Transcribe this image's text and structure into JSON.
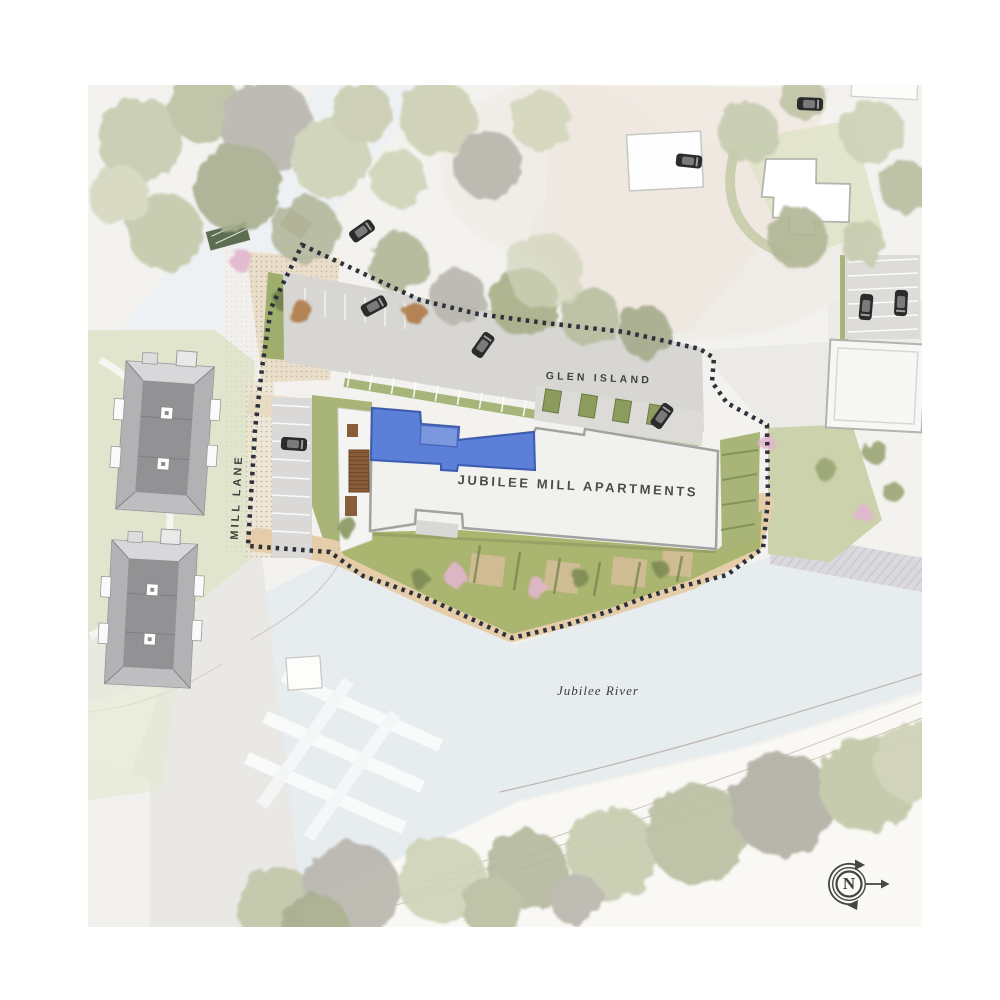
{
  "site_plan": {
    "labels": {
      "building": "JUBILEE MILL APARTMENTS",
      "area": "GLEN ISLAND",
      "road": "MILL LANE",
      "river": "Jubilee River"
    },
    "compass": {
      "north": "N"
    },
    "colors": {
      "unit_highlight": "#5c80d8",
      "unit_highlight_border": "#3b5cb0",
      "boundary_line": "#2d313c",
      "water": "#e7ecef",
      "grass": "#aab570",
      "promenade_path": "#e4cda8",
      "building_fill": "#f1f1ef",
      "roof_gray": "#929294"
    }
  }
}
